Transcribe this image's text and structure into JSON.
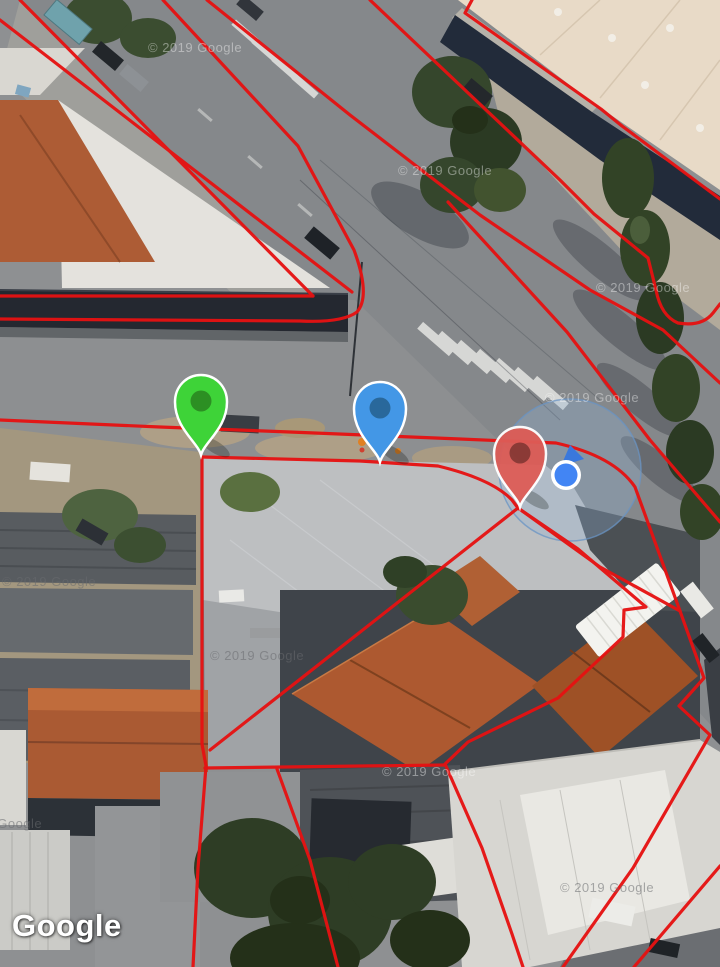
{
  "map": {
    "attribution": {
      "label": "Google"
    },
    "copyright_watermarks": [
      {
        "text": "© 2019 Google"
      },
      {
        "text": "© 2019 Google"
      },
      {
        "text": "© 2019 Google"
      },
      {
        "text": "© 2019 Google"
      },
      {
        "text": "© 2019 Google"
      },
      {
        "text": "© 2019 Google"
      },
      {
        "text": "© 2019 Google"
      },
      {
        "text": "© 2019 Google"
      },
      {
        "text": "© 2019 Google"
      }
    ],
    "markers": [
      {
        "id": "green-marker",
        "color": "#3ed338",
        "inner_color": "#2c8f23"
      },
      {
        "id": "blue-marker",
        "color": "#4397e6",
        "inner_color": "#29689b"
      },
      {
        "id": "red-marker",
        "color": "#dc5b56",
        "inner_color": "#8b3531"
      }
    ],
    "my_location": {
      "icon": "my-location-dot",
      "dot_color": "#4285f4",
      "ring_color": "#ffffff",
      "heading_color": "#3a78dc",
      "accuracy_fill": "rgba(145,178,214,0.30)",
      "accuracy_stroke": "rgba(105,148,196,0.75)"
    },
    "overlay": {
      "line_color": "#e51212"
    }
  }
}
